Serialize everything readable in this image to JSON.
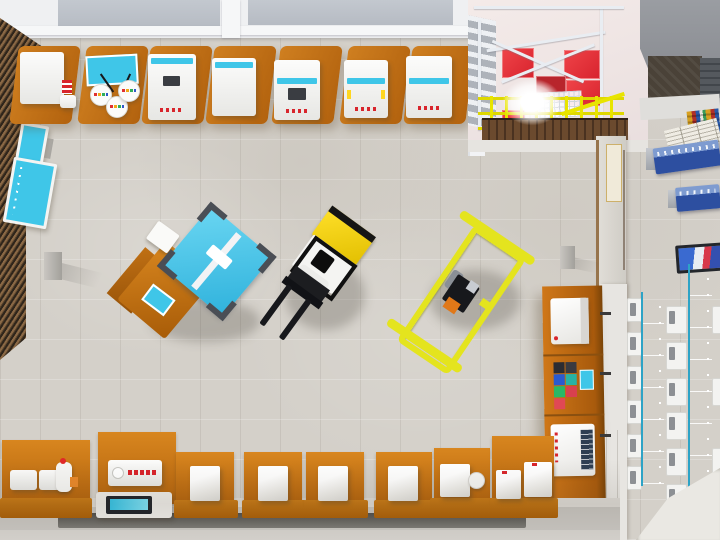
{
  "scene": {
    "title": "Top-down 3D render of a vocational training workshop with forklift, pallet cart and equipment benches",
    "view": "birds-eye interior render, no on-screen text or UI chrome",
    "colors": {
      "floor_marble": "#d4d0c9",
      "bench_orange": "#c9761b",
      "bench_orange_dark": "#a85a0c",
      "machine_white": "#f4f4f2",
      "accent_cyan": "#3fc6e8",
      "forklift_yellow": "#f2d40a",
      "cart_yellow": "#e4e41e",
      "red_panel": "#e63238",
      "steel_frame_white": "#e9edf2",
      "wood_slats": "#7a5a3a",
      "classroom_desk_cyan": "#4cc8e8",
      "display_case_blue": "#2d4fa0",
      "wall_light": "#dcd9d3",
      "roof_gray": "#8f9296",
      "dark_storeroom": "#4a4238"
    },
    "objects": {
      "vehicles": [
        {
          "name": "forklift",
          "color": "yellow-black-white",
          "heading": "forks toward lower-left"
        },
        {
          "name": "pallet-frame-cart",
          "color": "yellow frame",
          "load": "small pump unit with orange part"
        }
      ],
      "center_equipment": {
        "name": "cnc-worktable",
        "details": "cyan machine with dark corner brackets on rotated orange table, white box and cyan control pad"
      },
      "top_workbenches": [
        {
          "id": 1,
          "equipment": "white unit with red cartridge rack and drawer"
        },
        {
          "id": 2,
          "equipment": "cyan monitor panel with three round test pods"
        },
        {
          "id": 3,
          "equipment": "white cabinet, cyan header, dark screen, red indicator row"
        },
        {
          "id": 4,
          "equipment": "white cabinet with cyan header"
        },
        {
          "id": 5,
          "equipment": "white cabinet, cyan band, dark screen, red indicators"
        },
        {
          "id": 6,
          "equipment": "white cabinet, cyan band, yellow side labels"
        },
        {
          "id": 7,
          "equipment": "tall white cabinet, cyan band, red indicators"
        }
      ],
      "mezzanine": {
        "name": "steel-mezzanine-lift",
        "features": [
          "white steel frame",
          "red floor panels",
          "staircase",
          "yellow safety railing",
          "wood plank edge",
          "work light glare"
        ]
      },
      "left_wall": {
        "name": "wood-slat-wall",
        "boards": [
          "small cyan info board",
          "large cyan info board"
        ]
      },
      "right_shelf": {
        "name": "orange-supply-shelf",
        "items": [
          "white bench-top machine",
          "stack of colored part boxes with cyan tag",
          "white tester with dark control panel"
        ]
      },
      "corridor": {
        "cases": [
          "poster and document display",
          "blue tool display case A",
          "blue tool display case B"
        ],
        "floor_item": "tablet / colorful poster"
      },
      "classroom": {
        "desks": 2,
        "desk_color": "cyan",
        "chairs_per_row": 6,
        "extra": "white exit ramp"
      },
      "bottom_workstations": [
        {
          "id": 1,
          "equipment": "two white pads and small robot arm with red tip"
        },
        {
          "id": 2,
          "equipment": "wall unit with red dot row, tablet on white table"
        },
        {
          "id": 3,
          "equipment": "white storage cube"
        },
        {
          "id": 4,
          "equipment": "white storage cube"
        },
        {
          "id": 5,
          "equipment": "white storage cube"
        },
        {
          "id": 6,
          "equipment": "white storage cube"
        },
        {
          "id": 7,
          "equipment": "white box with round fitting"
        },
        {
          "id": 8,
          "equipment": "two white boxes with red marks"
        }
      ],
      "misc": [
        "gray pedestal left",
        "gray pedestal right",
        "floor recess channel along bottom walkway",
        "vertical plaque with four carved glyphs"
      ]
    }
  }
}
